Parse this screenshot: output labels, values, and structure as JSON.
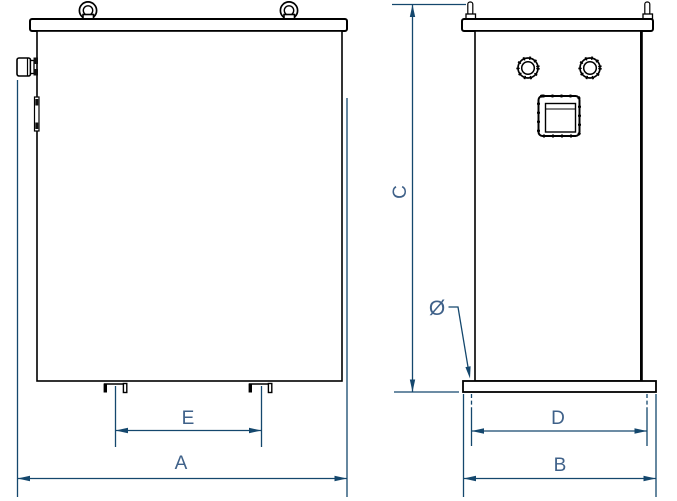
{
  "drawing": {
    "type": "technical-dimension-drawing",
    "labels": {
      "dim_a": "A",
      "dim_b": "B",
      "dim_c": "C",
      "dim_d": "D",
      "dim_e": "E",
      "diameter_symbol": "Ø"
    },
    "colors": {
      "background": "#ffffff",
      "drawing_line": "#000000",
      "dimension_line": "#14476d",
      "label_text": "#3f6189"
    }
  }
}
